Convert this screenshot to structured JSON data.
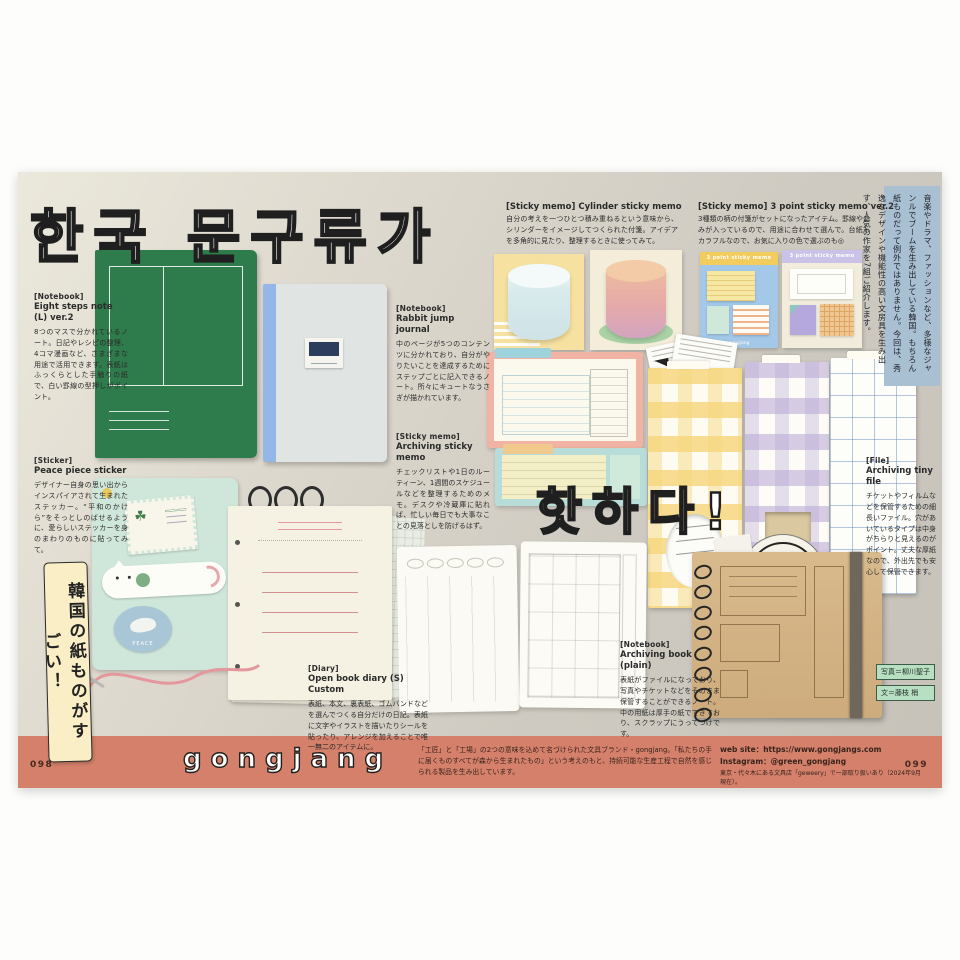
{
  "titles": {
    "main_hangul": "한국 문구류가",
    "sub_hangul": "핫하다!",
    "vertical_banner": "韓国の紙ものがすごい！"
  },
  "intro_box": "音楽やドラマ、ファッションなど、多様なジャンルでブームを生み出している韓国。もちろん紙ものだって例外ではありません。今回は、秀逸なデザインや機能性の高い文房具を生み出す、人気の作家を7組ご紹介します。",
  "products": [
    {
      "category": "[Notebook]",
      "name": "Eight steps note (L) ver.2",
      "description": "8つのマスで分かれているノート。日記やレシピの整理、4コマ漫画など、さまざまな用途で活用できます。表紙はふっくらとした手触りの紙で、白い罫線の型押しがポイント。"
    },
    {
      "category": "[Notebook]",
      "name": "Rabbit jump journal",
      "description": "中のページが5つのコンテンツに分かれており、自分がやりたいことを達成するためにステップごとに記入できるノート。所々にキュートなうさぎが描かれています。"
    },
    {
      "category": "[Sticky memo]",
      "name": "Cylinder sticky memo",
      "description": "自分の考えを一つひとつ積み重ねるという意味から、シリンダーをイメージしてつくられた付箋。アイデアを多角的に見たり、整理するときに使ってみて。"
    },
    {
      "category": "[Sticky memo]",
      "name": "3 point sticky memo ver.2",
      "description": "3種類の柄の付箋がセットになったアイテム。罫線やあみが入っているので、用途に合わせて選んで。台紙もカラフルなので、お気に入りの色で選ぶのも◎"
    },
    {
      "category": "[Sticky memo]",
      "name": "Archiving sticky memo",
      "description": "チェックリストや1日のルーティーン、1週間のスケジュールなどを整理するためのメモ。デスクや冷蔵庫に貼れば、忙しい毎日でも大事なことの見落としを防げるはず。"
    },
    {
      "category": "[Sticker]",
      "name": "Peace piece sticker",
      "description": "デザイナー自身の思い出からインスパイアされて生まれたステッカー。“平和のかけら”をそっとしのばせるように、愛らしいステッカーを身のまわりのものに貼ってみて。"
    },
    {
      "category": "[Diary]",
      "name": "Open book diary (S) Custom",
      "description": "表紙、本文、裏表紙、ゴムバンドなどを選んでつくる自分だけの日記。表紙に文字やイラストを描いたりシールを貼ったり、アレンジを加えることで唯一無二のアイテムに。"
    },
    {
      "category": "[Notebook]",
      "name": "Archiving book (plain)",
      "description": "表紙がファイルになっており、写真やチケットなどをそのまま保管することができるノート。中の用紙は厚手の紙でできており、スクラップにうってつけです。"
    },
    {
      "category": "[File]",
      "name": "Archiving tiny file",
      "description": "チケットやフィルムなどを保管するための細長いファイル。穴があいているタイプは中身がちらりと見えるのがポイント。丈夫な厚紙なので、外出先でも安心して保管できます。"
    }
  ],
  "card_labels": {
    "three_point_header": "3 point sticky memo",
    "bread_wrapper": "PAULAN",
    "dove_sticker": "PEACE"
  },
  "credits": {
    "photo": "写真＝柳川聖子",
    "text": "文＝藤枝 梢"
  },
  "footer": {
    "page_left": "098",
    "page_right": "099",
    "brand": "gongjang",
    "brand_description": "「工匠」と「工場」の2つの意味を込めて名づけられた文具ブランド・gongjang。「私たちの手に届くものすべてが森から生まれたもの」という考えのもと、持続可能な生産工程で自然を感じられる製品を生み出しています。",
    "web_site": "web site：https://www.gongjangs.com",
    "instagram": "Instagram：@green_gongjang",
    "shop_note": "東京・代々木にある文具店「geweery」で一部取り扱いあり（2024年9月現在）。"
  }
}
